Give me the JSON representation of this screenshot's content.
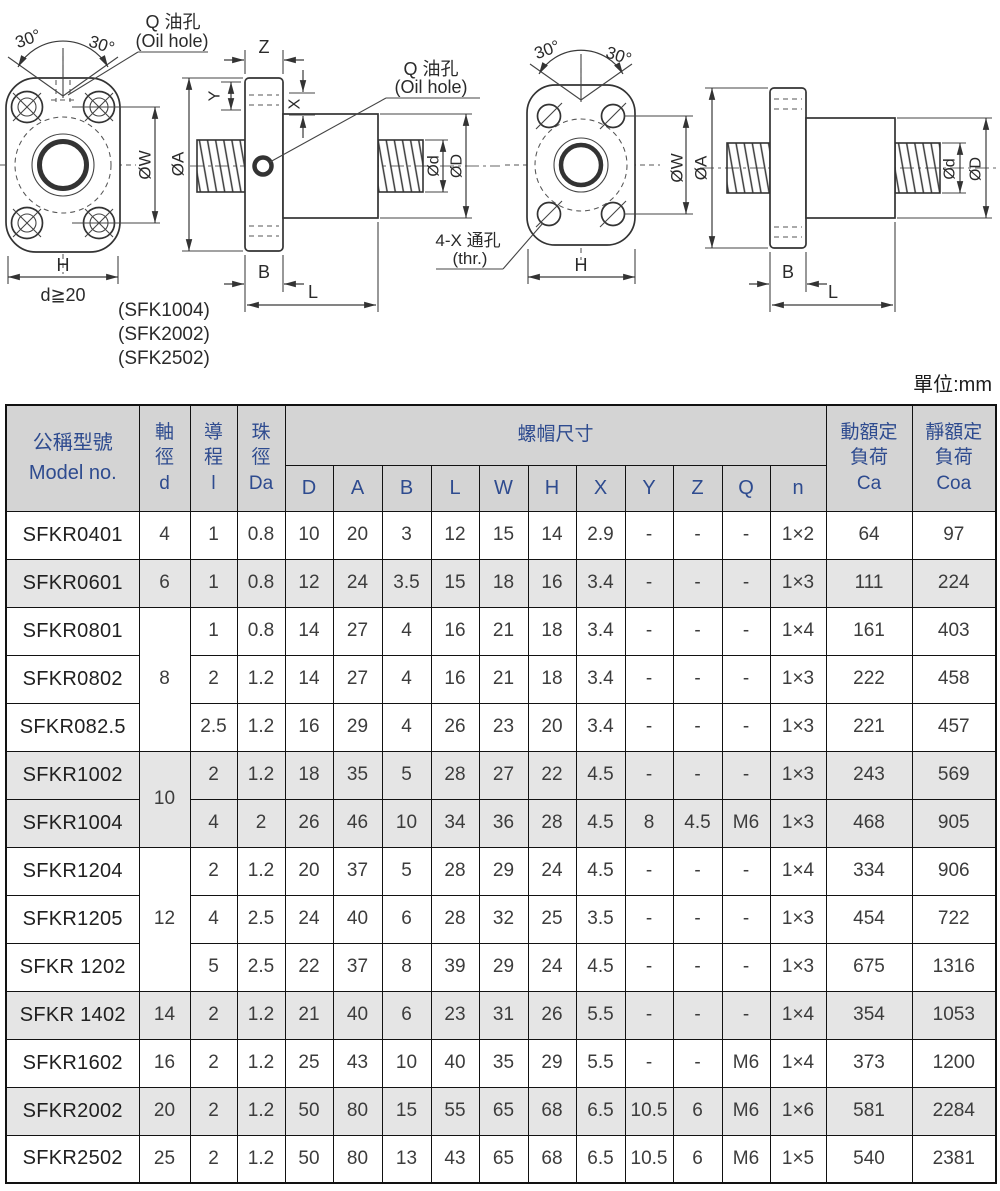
{
  "page": {
    "unit_label": "單位:mm"
  },
  "drawings": {
    "left_front": {
      "angle_left": "30°",
      "angle_right": "30°",
      "oil_line1": "Q 油孔",
      "oil_line2": "(Oil hole)",
      "dim_w": "ØW",
      "dim_h": "H",
      "note": "d≧20"
    },
    "left_side": {
      "dim_a": "ØA",
      "dim_z": "Z",
      "dim_y": "Y",
      "dim_x": "X",
      "oil_line1": "Q 油孔",
      "oil_line2": "(Oil hole)",
      "dim_d": "Ød",
      "dim_D": "ØD",
      "dim_b": "B",
      "dim_l": "L",
      "models": [
        "(SFK1004)",
        "(SFK2002)",
        "(SFK2502)"
      ]
    },
    "right_front": {
      "angle_left": "30°",
      "angle_right": "30°",
      "dim_w": "ØW",
      "dim_h": "H",
      "thru_line1": "4-X 通孔",
      "thru_line2": "(thr.)"
    },
    "right_side": {
      "dim_a": "ØA",
      "dim_d": "Ød",
      "dim_D": "ØD",
      "dim_b": "B",
      "dim_l": "L"
    }
  },
  "table": {
    "headers": {
      "model": "公稱型號\nModel no.",
      "shaft": "軸\n徑\nd",
      "lead": "導\n程\nl",
      "ball": "珠\n徑\nDa",
      "nut_group": "螺帽尺寸",
      "nut_cols": [
        "D",
        "A",
        "B",
        "L",
        "W",
        "H",
        "X",
        "Y",
        "Z",
        "Q",
        "n"
      ],
      "ca": "動額定\n負荷\nCa",
      "coa": "靜額定\n負荷\nCoa"
    },
    "rows": [
      {
        "model": "SFKR0401",
        "d": "4",
        "d_rowspan": 1,
        "cells": [
          "1",
          "0.8",
          "10",
          "20",
          "3",
          "12",
          "15",
          "14",
          "2.9",
          "-",
          "-",
          "-",
          "1×2"
        ],
        "ca": "64",
        "coa": "97",
        "shaded": false
      },
      {
        "model": "SFKR0601",
        "d": "6",
        "d_rowspan": 1,
        "cells": [
          "1",
          "0.8",
          "12",
          "24",
          "3.5",
          "15",
          "18",
          "16",
          "3.4",
          "-",
          "-",
          "-",
          "1×3"
        ],
        "ca": "111",
        "coa": "224",
        "shaded": true
      },
      {
        "model": "SFKR0801",
        "d": "8",
        "d_rowspan": 3,
        "cells": [
          "1",
          "0.8",
          "14",
          "27",
          "4",
          "16",
          "21",
          "18",
          "3.4",
          "-",
          "-",
          "-",
          "1×4"
        ],
        "ca": "161",
        "coa": "403",
        "shaded": false
      },
      {
        "model": "SFKR0802",
        "d": null,
        "cells": [
          "2",
          "1.2",
          "14",
          "27",
          "4",
          "16",
          "21",
          "18",
          "3.4",
          "-",
          "-",
          "-",
          "1×3"
        ],
        "ca": "222",
        "coa": "458",
        "shaded": false
      },
      {
        "model": "SFKR082.5",
        "d": null,
        "cells": [
          "2.5",
          "1.2",
          "16",
          "29",
          "4",
          "26",
          "23",
          "20",
          "3.4",
          "-",
          "-",
          "-",
          "1×3"
        ],
        "ca": "221",
        "coa": "457",
        "shaded": false
      },
      {
        "model": "SFKR1002",
        "d": "10",
        "d_rowspan": 2,
        "cells": [
          "2",
          "1.2",
          "18",
          "35",
          "5",
          "28",
          "27",
          "22",
          "4.5",
          "-",
          "-",
          "-",
          "1×3"
        ],
        "ca": "243",
        "coa": "569",
        "shaded": true
      },
      {
        "model": "SFKR1004",
        "d": null,
        "cells": [
          "4",
          "2",
          "26",
          "46",
          "10",
          "34",
          "36",
          "28",
          "4.5",
          "8",
          "4.5",
          "M6",
          "1×3"
        ],
        "ca": "468",
        "coa": "905",
        "shaded": true
      },
      {
        "model": "SFKR1204",
        "d": "12",
        "d_rowspan": 3,
        "cells": [
          "2",
          "1.2",
          "20",
          "37",
          "5",
          "28",
          "29",
          "24",
          "4.5",
          "-",
          "-",
          "-",
          "1×4"
        ],
        "ca": "334",
        "coa": "906",
        "shaded": false
      },
      {
        "model": "SFKR1205",
        "d": null,
        "cells": [
          "4",
          "2.5",
          "24",
          "40",
          "6",
          "28",
          "32",
          "25",
          "3.5",
          "-",
          "-",
          "-",
          "1×3"
        ],
        "ca": "454",
        "coa": "722",
        "shaded": false
      },
      {
        "model": "SFKR 1202",
        "d": null,
        "cells": [
          "5",
          "2.5",
          "22",
          "37",
          "8",
          "39",
          "29",
          "24",
          "4.5",
          "-",
          "-",
          "-",
          "1×3"
        ],
        "ca": "675",
        "coa": "1316",
        "shaded": false
      },
      {
        "model": "SFKR 1402",
        "d": "14",
        "d_rowspan": 1,
        "cells": [
          "2",
          "1.2",
          "21",
          "40",
          "6",
          "23",
          "31",
          "26",
          "5.5",
          "-",
          "-",
          "-",
          "1×4"
        ],
        "ca": "354",
        "coa": "1053",
        "shaded": true
      },
      {
        "model": "SFKR1602",
        "d": "16",
        "d_rowspan": 1,
        "cells": [
          "2",
          "1.2",
          "25",
          "43",
          "10",
          "40",
          "35",
          "29",
          "5.5",
          "-",
          "-",
          "M6",
          "1×4"
        ],
        "ca": "373",
        "coa": "1200",
        "shaded": false
      },
      {
        "model": "SFKR2002",
        "d": "20",
        "d_rowspan": 1,
        "cells": [
          "2",
          "1.2",
          "50",
          "80",
          "15",
          "55",
          "65",
          "68",
          "6.5",
          "10.5",
          "6",
          "M6",
          "1×6"
        ],
        "ca": "581",
        "coa": "2284",
        "shaded": true
      },
      {
        "model": "SFKR2502",
        "d": "25",
        "d_rowspan": 1,
        "cells": [
          "2",
          "1.2",
          "50",
          "80",
          "13",
          "43",
          "65",
          "68",
          "6.5",
          "10.5",
          "6",
          "M6",
          "1×5"
        ],
        "ca": "540",
        "coa": "2381",
        "shaded": false
      }
    ]
  }
}
